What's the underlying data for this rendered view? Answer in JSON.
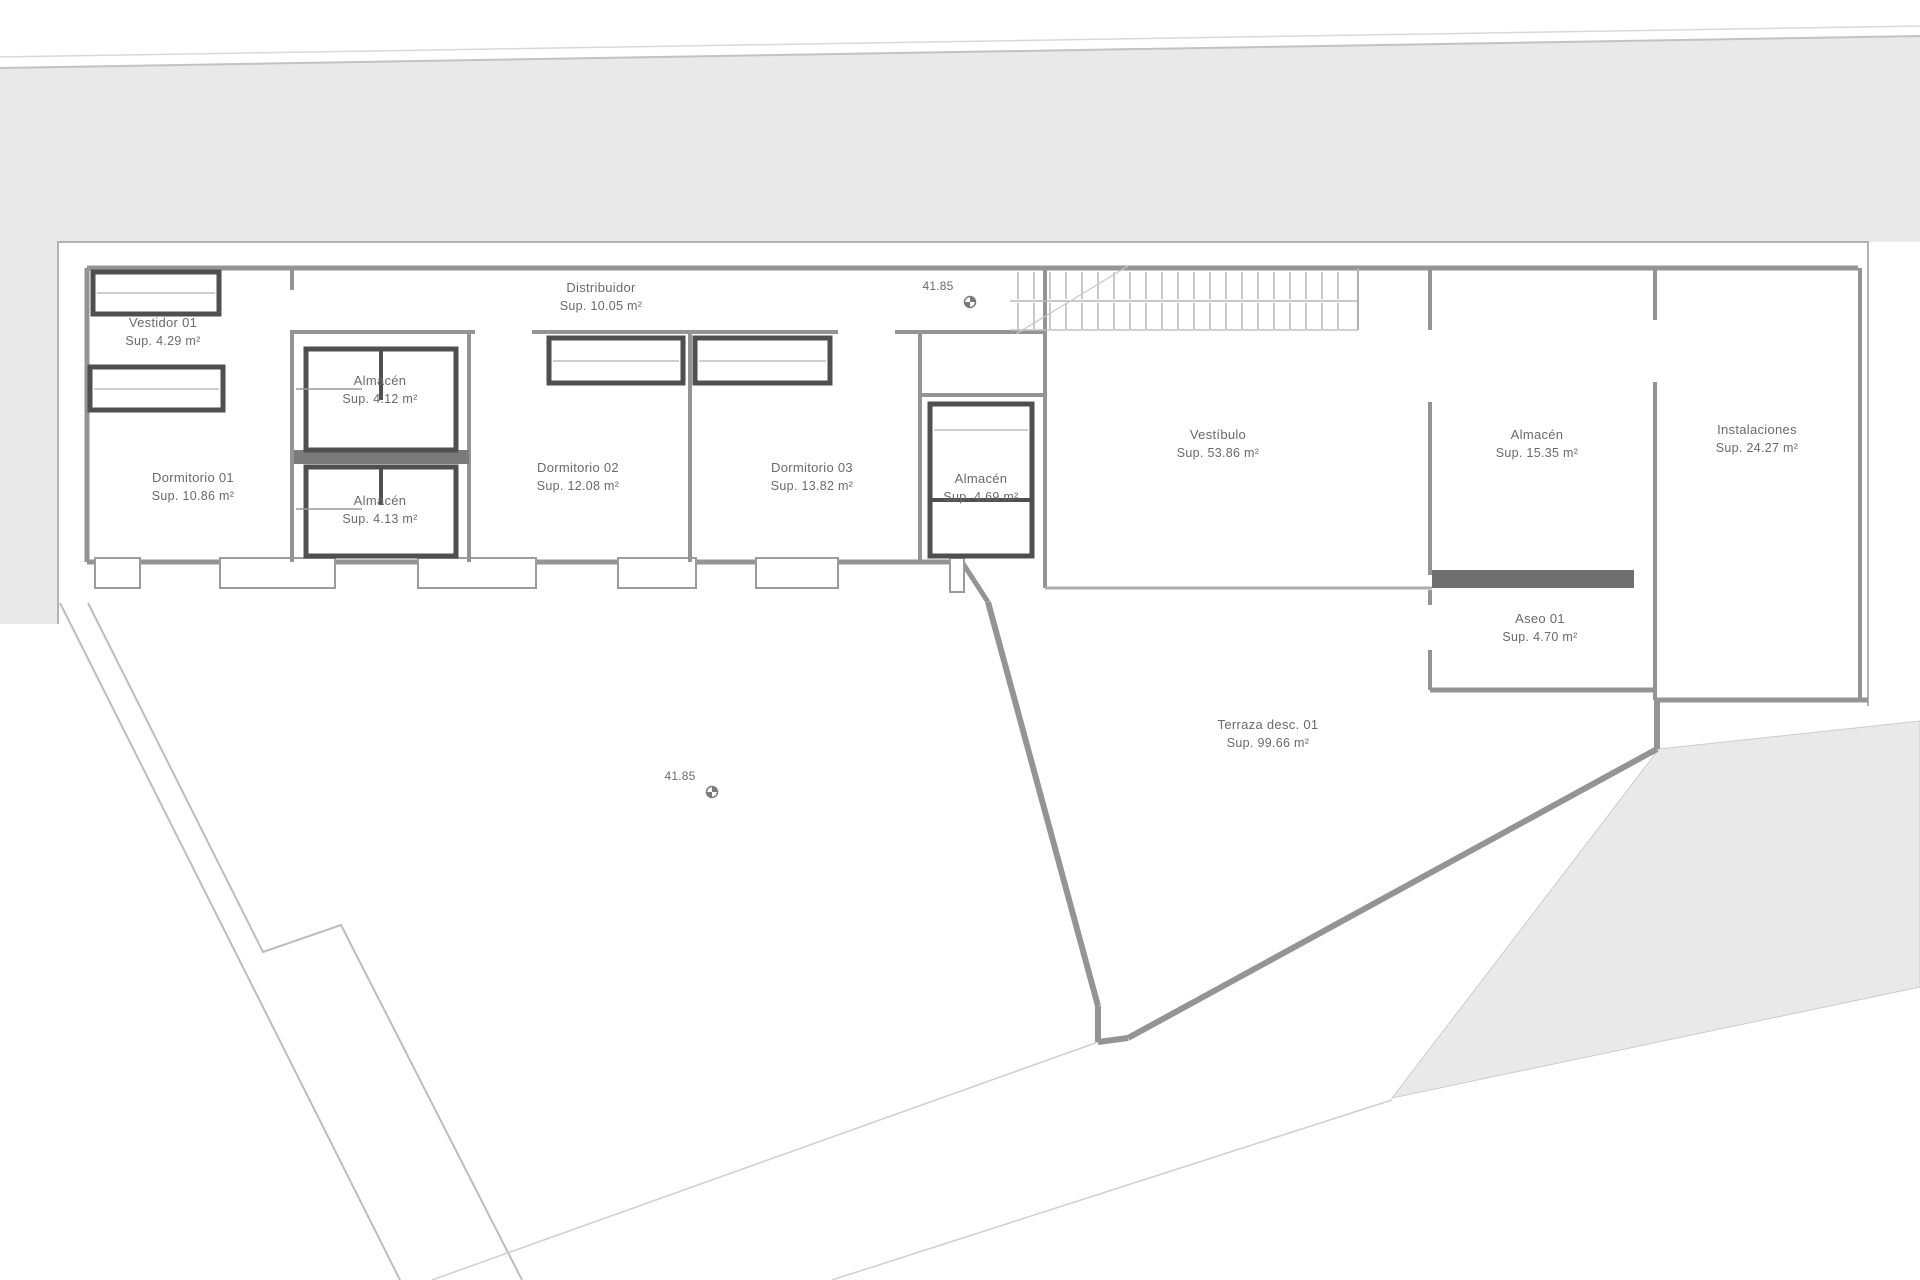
{
  "drawing": {
    "type": "architectural-floor-plan",
    "language": "es",
    "colors": {
      "background": "#ffffff",
      "site_fill": "#e9e9e9",
      "wall": "#949494",
      "dark_wall": "#4f4f4f",
      "thin_line": "#b3b3b3",
      "text": "#6a6a6a"
    }
  },
  "rooms": [
    {
      "id": "vestidor-01",
      "name": "Vestidor 01",
      "area": "Sup.  4.29 m²",
      "cx": 163,
      "cy": 334
    },
    {
      "id": "dormitorio-01",
      "name": "Dormitorio 01",
      "area": "Sup.  10.86 m²",
      "cx": 193,
      "cy": 489
    },
    {
      "id": "almacen-a",
      "name": "Almacén",
      "area": "Sup.  4.12 m²",
      "cx": 380,
      "cy": 392
    },
    {
      "id": "almacen-b",
      "name": "Almacén",
      "area": "Sup.  4.13 m²",
      "cx": 380,
      "cy": 512
    },
    {
      "id": "distribuidor",
      "name": "Distribuidor",
      "area": "Sup.  10.05 m²",
      "cx": 601,
      "cy": 299
    },
    {
      "id": "dormitorio-02",
      "name": "Dormitorio 02",
      "area": "Sup.  12.08 m²",
      "cx": 578,
      "cy": 479
    },
    {
      "id": "dormitorio-03",
      "name": "Dormitorio 03",
      "area": "Sup.  13.82 m²",
      "cx": 812,
      "cy": 479
    },
    {
      "id": "almacen-c",
      "name": "Almacén",
      "area": "Sup.  4.69 m²",
      "cx": 981,
      "cy": 490
    },
    {
      "id": "vestibulo",
      "name": "Vestíbulo",
      "area": "Sup.  53.86 m²",
      "cx": 1218,
      "cy": 446
    },
    {
      "id": "almacen-d",
      "name": "Almacén",
      "area": "Sup.  15.35 m²",
      "cx": 1537,
      "cy": 446
    },
    {
      "id": "instalaciones",
      "name": "Instalaciones",
      "area": "Sup.  24.27 m²",
      "cx": 1757,
      "cy": 441
    },
    {
      "id": "aseo-01",
      "name": "Aseo 01",
      "area": "Sup.  4.70 m²",
      "cx": 1540,
      "cy": 630
    },
    {
      "id": "terraza-01",
      "name": "Terraza desc. 01",
      "area": "Sup.  99.66 m²",
      "cx": 1268,
      "cy": 736
    }
  ],
  "levels": [
    {
      "id": "level-upper",
      "label": "41.85",
      "x": 938,
      "y": 290
    },
    {
      "id": "level-lower",
      "label": "41.85",
      "x": 680,
      "y": 780
    }
  ]
}
